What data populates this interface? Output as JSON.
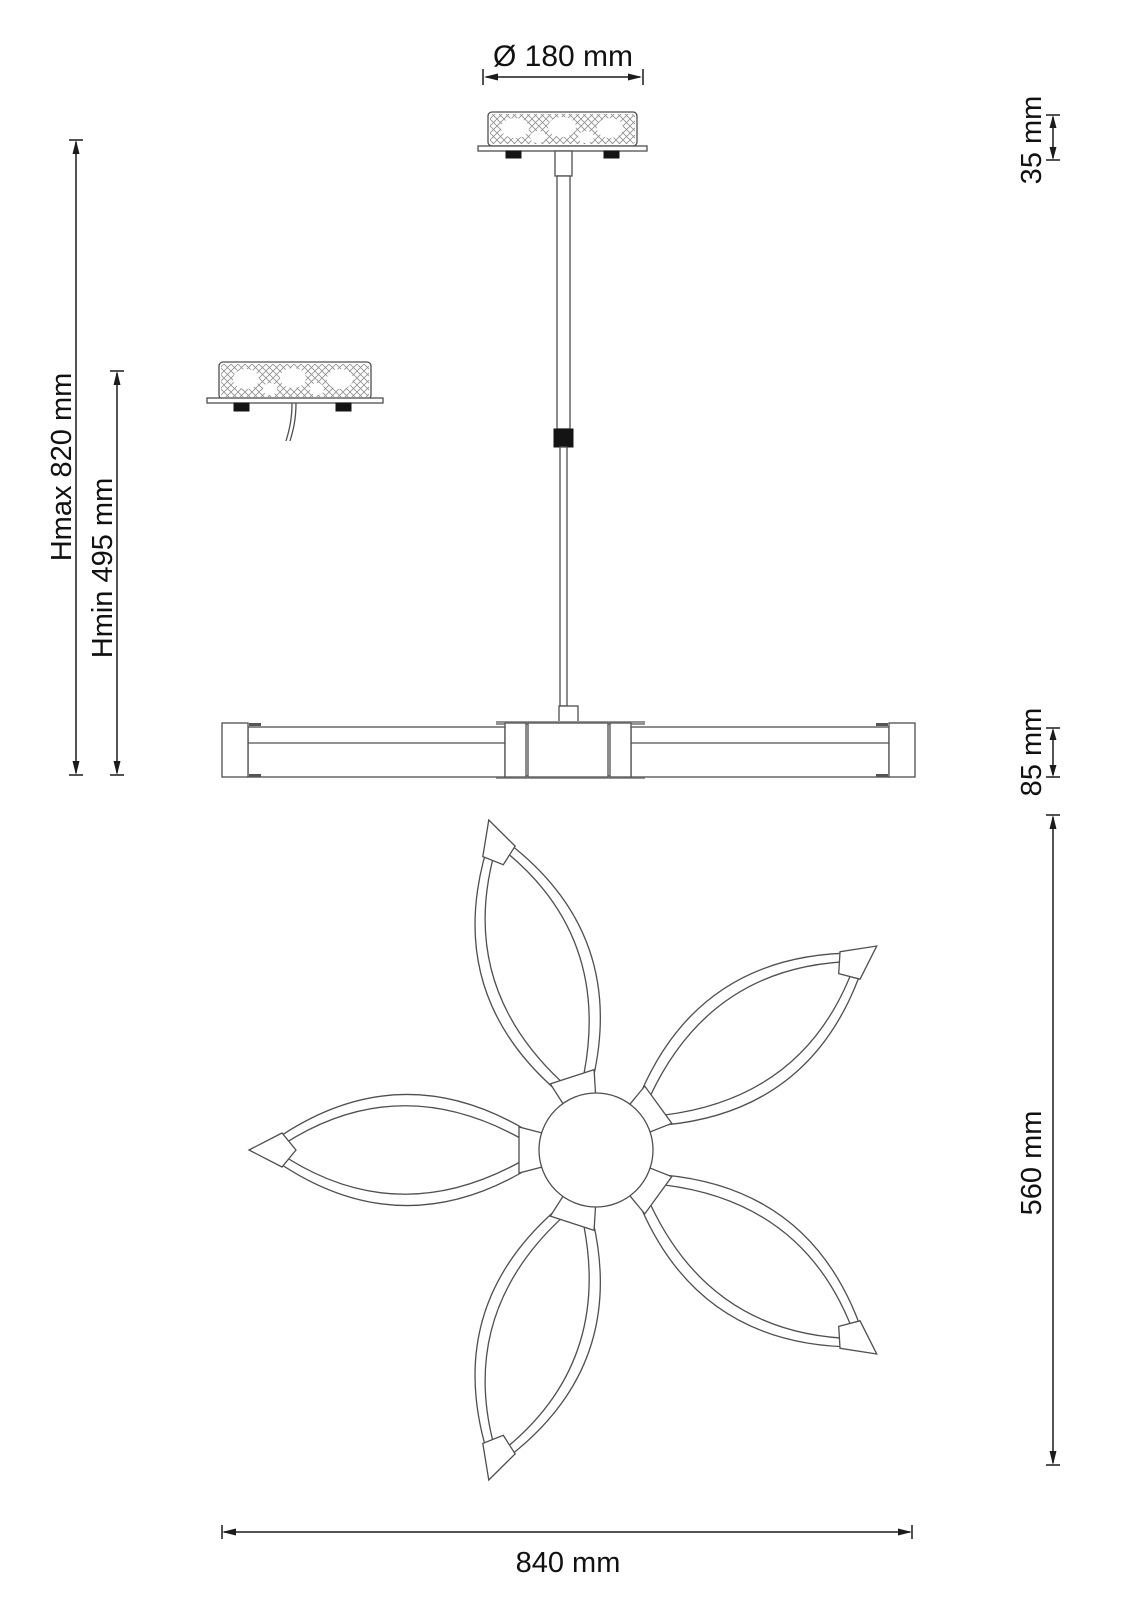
{
  "drawing": {
    "type": "luminaire-dimension-drawing",
    "views": {
      "canopy_side": "ceiling canopy side view",
      "canopy_detail": "canopy detail view",
      "lamp_bar_side": "lamp bar side view",
      "lamp_top": "lamp flower top view"
    },
    "dimensions": {
      "canopy_diameter": "Ø 180 mm",
      "canopy_height": "35 mm",
      "height_max": "Hmax 820 mm",
      "height_min": "Hmin 495 mm",
      "bar_height": "85 mm",
      "top_view_depth": "560 mm",
      "top_view_width": "840 mm"
    },
    "colors": {
      "background": "#ffffff",
      "outline": "#4f4f4f",
      "dimension": "#1b1b1b",
      "dark_fill": "#141414"
    }
  }
}
